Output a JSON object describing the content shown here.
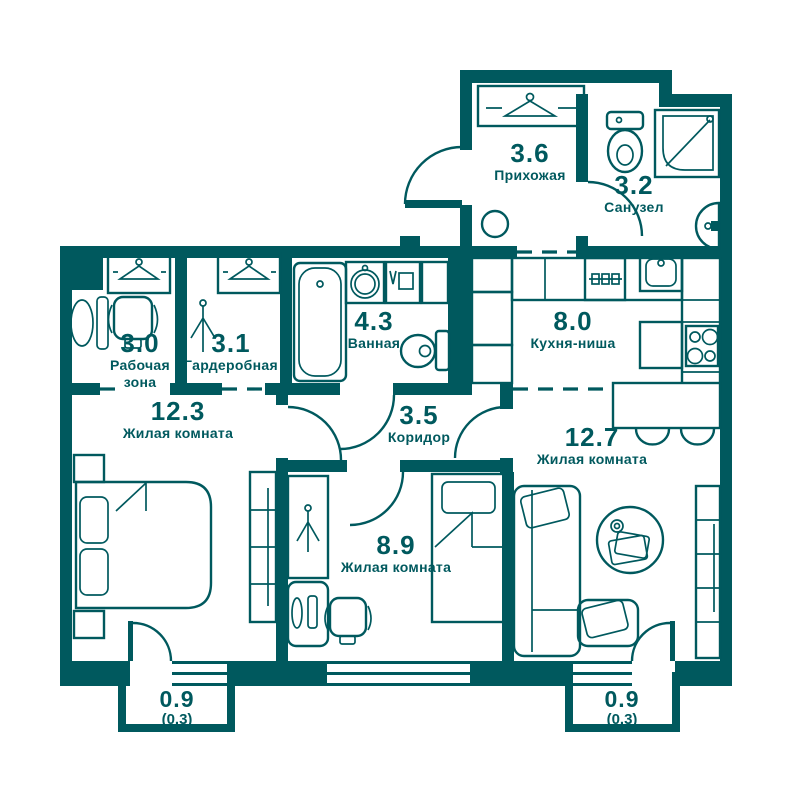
{
  "title": "Apartment floor plan",
  "colors": {
    "line": "#00595e",
    "background": "#ffffff",
    "table_fill": "#ffffff"
  },
  "rooms": [
    {
      "id": "hallway",
      "area": "3.6",
      "name": "Прихожая"
    },
    {
      "id": "bathroom-2",
      "area": "3.2",
      "name": "Санузел"
    },
    {
      "id": "work-zone",
      "area": "3.0",
      "name": "Рабочая зона"
    },
    {
      "id": "wardrobe-room",
      "area": "3.1",
      "name": "Гардеробная"
    },
    {
      "id": "bathroom",
      "area": "4.3",
      "name": "Ванная"
    },
    {
      "id": "kitchen-niche",
      "area": "8.0",
      "name": "Кухня-ниша"
    },
    {
      "id": "living-room-1",
      "area": "12.3",
      "name": "Жилая комната"
    },
    {
      "id": "corridor",
      "area": "3.5",
      "name": "Коридор"
    },
    {
      "id": "living-room-2",
      "area": "12.7",
      "name": "Жилая комната"
    },
    {
      "id": "living-room-3",
      "area": "8.9",
      "name": "Жилая комната"
    },
    {
      "id": "balcony-left",
      "area": "0.9",
      "area_reduced": "(0.3)"
    },
    {
      "id": "balcony-right",
      "area": "0.9",
      "area_reduced": "(0.3)"
    }
  ]
}
